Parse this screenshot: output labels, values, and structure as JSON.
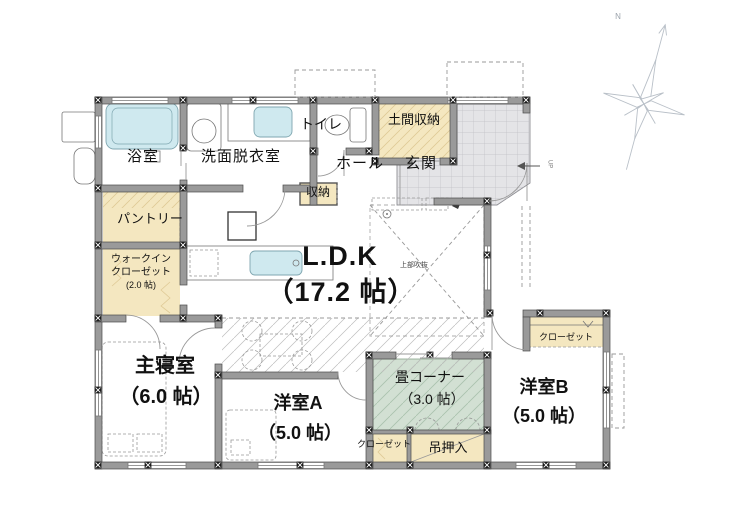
{
  "labels": {
    "bath": "浴室",
    "washroom": "洗面脱衣室",
    "toilet": "トイレ",
    "doma_storage": "土間収納",
    "hall": "ホール",
    "entrance": "玄関",
    "hall_storage": "収納",
    "pantry": "パントリー",
    "wic_line1": "ウォークイン",
    "wic_line2": "クローゼット",
    "wic_size": "(2.0 帖)",
    "ldk": "L.D.K",
    "ldk_size": "（17.2 帖）",
    "void_above": "上部吹抜",
    "master": "主寝室",
    "master_size": "（6.0 帖）",
    "room_a": "洋室A",
    "room_a_size": "（5.0 帖）",
    "tatami": "畳コーナー",
    "tatami_size": "（3.0 帖）",
    "room_b": "洋室B",
    "room_b_size": "（5.0 帖）",
    "closet_a": "クローゼット",
    "closet_b": "クローゼット",
    "hanging_closet": "吊押入",
    "compass_n": "N",
    "up": "UP"
  },
  "colors": {
    "wall": "#9a9a9a",
    "wall_edge": "#4a4a4a",
    "beige": "#f4e7c0",
    "beige_hatch": "#dfca96",
    "tatami": "#d2e0d3",
    "tatami_hatch": "#aac2ad",
    "tile": "#e4e4e7",
    "tile_grid": "#bfbfc4",
    "water": "#cfe9ef",
    "water_edge": "#7fa6b0",
    "ink": "#111111",
    "line": "#999999",
    "compass": "#b9c0c8"
  }
}
